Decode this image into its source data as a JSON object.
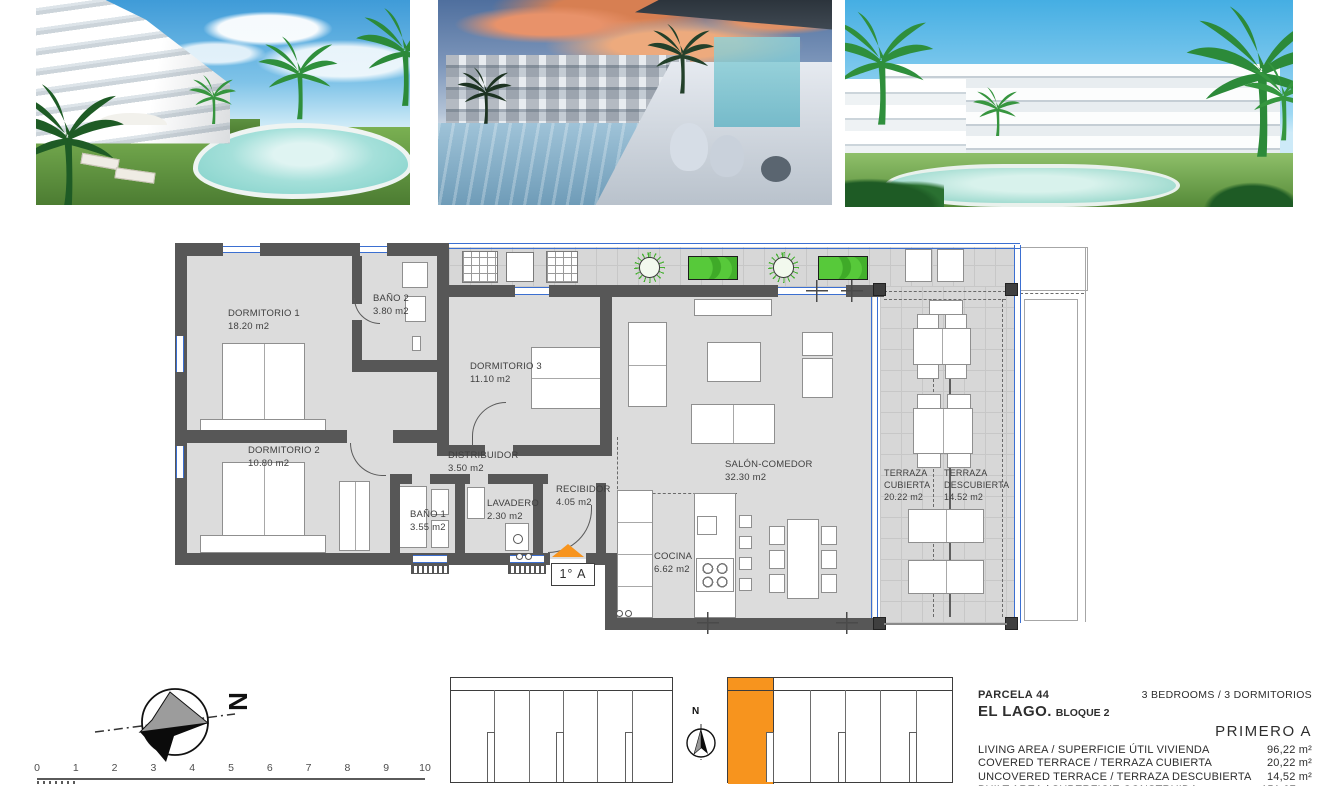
{
  "floor_plan": {
    "rooms": [
      {
        "id": "dormitorio-1",
        "name": "DORMITORIO 1",
        "area": "18.20 m2"
      },
      {
        "id": "bano-2",
        "name": "BAÑO 2",
        "area": "3.80 m2"
      },
      {
        "id": "dormitorio-3",
        "name": "DORMITORIO 3",
        "area": "11.10 m2"
      },
      {
        "id": "dormitorio-2",
        "name": "DORMITORIO 2",
        "area": "10.80 m2"
      },
      {
        "id": "distribuidor",
        "name": "DISTRIBUIDOR",
        "area": "3.50 m2"
      },
      {
        "id": "bano-1",
        "name": "BAÑO 1",
        "area": "3.55 m2"
      },
      {
        "id": "lavadero",
        "name": "LAVADERO",
        "area": "2.30 m2"
      },
      {
        "id": "recibidor",
        "name": "RECIBIDOR",
        "area": "4.05 m2"
      },
      {
        "id": "cocina",
        "name": "COCINA",
        "area": "6.62 m2"
      },
      {
        "id": "salon-comedor",
        "name": "SALÓN-COMEDOR",
        "area": "32.30 m2"
      },
      {
        "id": "terraza-cubierta",
        "name": "TERRAZA CUBIERTA",
        "area": "20.22 m2"
      },
      {
        "id": "terraza-descubierta",
        "name": "TERRAZA DESCUBIERTA",
        "area": "14.52 m2"
      }
    ],
    "entrance_label": "1° A",
    "compass_letter": "N"
  },
  "scale_bar": {
    "ticks": [
      "0",
      "1",
      "2",
      "3",
      "4",
      "5",
      "6",
      "7",
      "8",
      "9",
      "10"
    ]
  },
  "key_plan": {
    "north_letter": "N",
    "highlight_color": "#F7941E"
  },
  "info_panel": {
    "parcela": "PARCELA 44",
    "project": "EL LAGO.",
    "bloque": "BLOQUE 2",
    "bedrooms": "3 BEDROOMS / 3 DORMITORIOS",
    "unit": "PRIMERO A",
    "rows": [
      {
        "label": "LIVING AREA / SUPERFICIE ÚTIL VIVIENDA",
        "value": "96,22 m²"
      },
      {
        "label": "COVERED TERRACE / TERRAZA CUBIERTA",
        "value": "20,22 m²"
      },
      {
        "label": "UNCOVERED TERRACE / TERRAZA DESCUBIERTA",
        "value": "14,52 m²"
      },
      {
        "label": "BUILT AREA / SUPERFICIE CONSTRUIDA PROYECTO",
        "value": "151,07 m²"
      }
    ]
  },
  "colors": {
    "accent_orange": "#F7941E",
    "wall_gray": "#575757",
    "floor_gray": "#DCDCDC",
    "window_blue": "#3B6FD1",
    "plant_green": "#46B031"
  }
}
